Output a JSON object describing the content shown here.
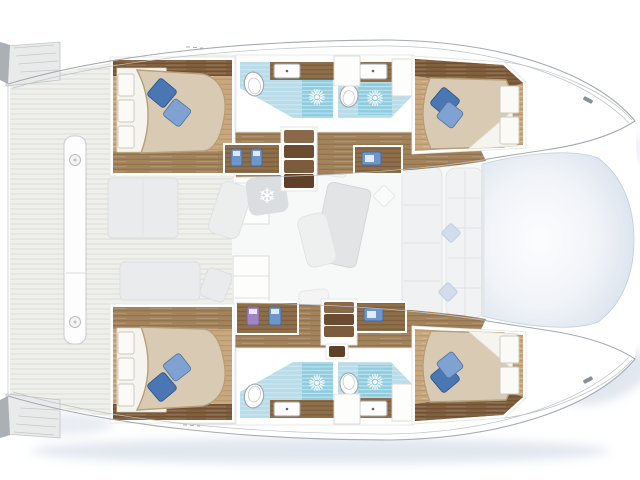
{
  "scene": {
    "type": "floorplan",
    "subject": "catamaran yacht deck plan, top view, bows to the right",
    "cabin_count": 4,
    "head_count": 4,
    "highlighted_zones": "hull cabins and bathrooms in color, saloon and decks faded gray"
  },
  "icons": {
    "snowflake_glyph": "❄",
    "shower_icon": "sun-burst",
    "cleat_icon": "cleat",
    "plank_screw_icon": "circle-screw"
  },
  "colors": {
    "outline": "#a5abb1",
    "outline_faint": "#bcc2c7",
    "deck_base": "#efefec",
    "deck_line": "#dcdcd6",
    "wood_floor": "#c9a87e",
    "wood_mid": "#a3835c",
    "wood_dark": "#82603e",
    "wood_counter": "#8f6f4a",
    "step_a": "#8a684a",
    "step_b": "#6b4c31",
    "step_c": "#7d5c3d",
    "step_d": "#5e4128",
    "bed_cover": "#d9cbb3",
    "bed_edge": "#b79f7b",
    "pillow_dark": "#4a77b4",
    "pillow_light": "#7fa2d2",
    "bath_floor": "#b9dcea",
    "shower_tile": "#8fccdf",
    "item_blue": "#6d96cc",
    "item_purple": "#9f85c6",
    "salon_bg": "#f7f8f8",
    "shadow_blue": "#c9d4e3",
    "tramp_edge": "#c7d2e2"
  }
}
